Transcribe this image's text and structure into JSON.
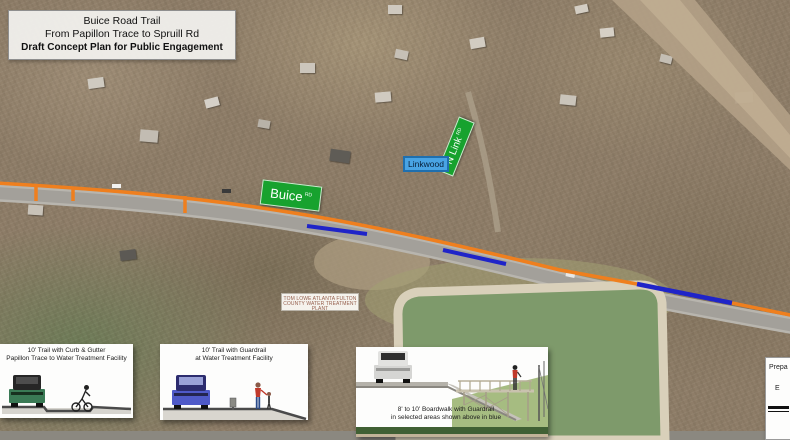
{
  "map": {
    "title_box": {
      "line1": "Buice Road Trail",
      "line2": "From Papillon Trace to Spruill Rd",
      "line3": "Draft Concept Plan for Public Engagement"
    },
    "street_signs": {
      "buice": {
        "name": "Buice",
        "suffix": "RD"
      },
      "n_link": {
        "name": "N Link",
        "suffix": "RD"
      },
      "linkwood": "Linkwood"
    },
    "facility_label": {
      "line1": "TOM LOWE ATLANTA FULTON",
      "line2": "COUNTY WATER TREATMENT PLANT"
    }
  },
  "legend_panels": [
    {
      "caption_line1": "10' Trail with Curb & Gutter",
      "caption_line2": "Papillon Trace to Water Treatment Facility"
    },
    {
      "caption_line1": "10' Trail with Guardrail",
      "caption_line2": "at Water Treatment Facility"
    },
    {
      "caption_line1": "8' to 10' Boardwalk with Guardrail",
      "caption_line2": "in selected areas shown above in blue"
    }
  ],
  "prepared_panel": {
    "line1": "Prepa",
    "line2": "E"
  },
  "colors": {
    "trail_orange": "#ef7f1e",
    "boardwalk_blue": "#1f24c8",
    "sign_green": "#17a22e",
    "linkwood_fill": "#49a4e4",
    "pond_water": "#7e9a6b",
    "road_gray": "#a3a09a"
  }
}
